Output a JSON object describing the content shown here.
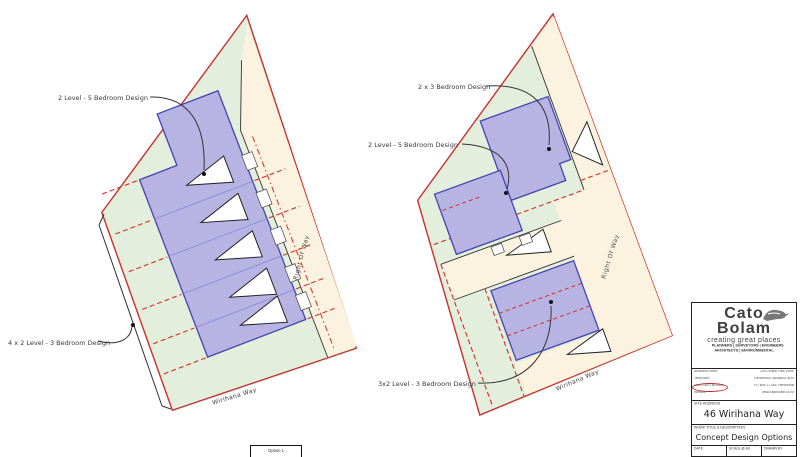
{
  "plans": {
    "left": {
      "label_top": "2 Level - 5 Bedroom Design",
      "label_bottom": "4 x 2 Level - 3 Bedroom Design",
      "right_of_way_label": "Right Of Way",
      "street_label": "Wirihana Way"
    },
    "right": {
      "label_top": "2 x 3 Bedroom Design",
      "label_mid": "2 Level - 5 Bedroom Design",
      "label_bottom": "3x2 Level - 3 Bedroom Design",
      "right_of_way_label": "Right Of Way",
      "street_label": "Wirihana Way"
    }
  },
  "bottom_box": {
    "label": "Option 1"
  },
  "title_block": {
    "brand_line1": "Cato",
    "brand_line2": "Bolam",
    "tagline": "creating great places",
    "disciplines_line1": "PLANNERS | SURVEYORS | ENGINEERS",
    "disciplines_line2": "ARCHITECTS | ENVIRONMENTAL",
    "contact_left": [
      "Auckland Office:",
      "Telephone:",
      "0800 CATO BOLAM",
      "Website:"
    ],
    "contact_right": [
      "108 Central Park Drive,",
      "Henderson, Auckland 0610",
      "PO Box 21 445, Henderson",
      "www.catobolam.co.nz"
    ],
    "site_address_label": "SITE ADDRESS",
    "site_address_value": "46 Wirihana Way",
    "work_title_label": "WORK TITLE & DESCRIPTION",
    "work_title_value": "Concept Design Options",
    "footer": {
      "date_label": "DATE",
      "scale_label": "SCALE @ A3",
      "drawn_label": "DRAWN BY"
    }
  },
  "colors": {
    "site_green": "#e3efdc",
    "boundary_red": "#c5322d",
    "building_blue_fill": "#b7b4e4",
    "building_blue_stroke": "#4543ad",
    "row_cream": "#fbf3e0",
    "dashed_red": "#d03028",
    "accent_red": "#cc2222"
  }
}
